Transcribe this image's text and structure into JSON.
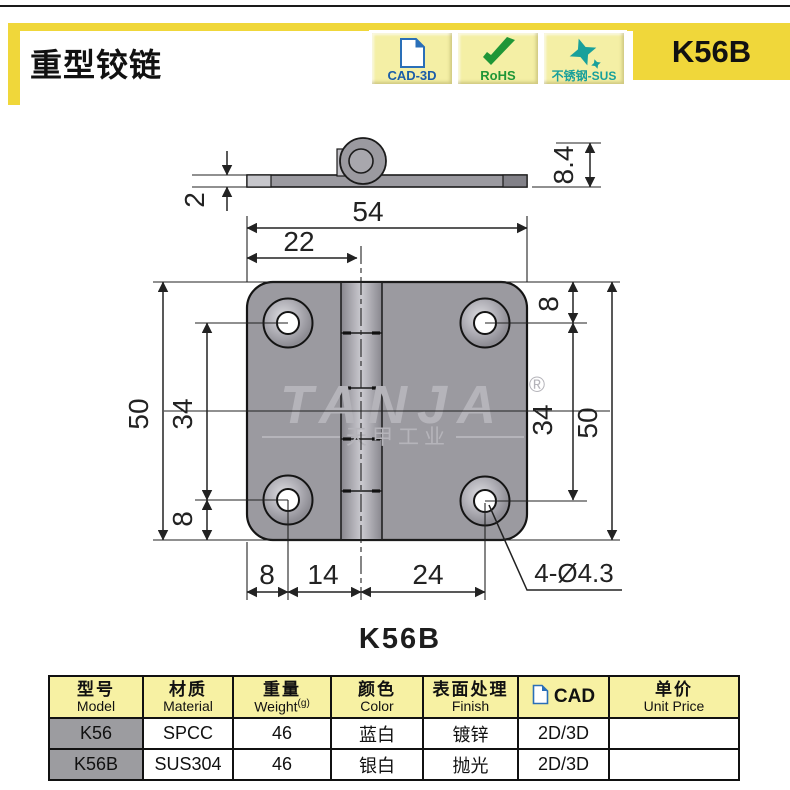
{
  "header": {
    "title": "重型铰链",
    "product_code": "K56B",
    "badges": [
      {
        "label": "CAD-3D",
        "icon": "document-icon",
        "color": "#1A5DA8"
      },
      {
        "label": "RoHS",
        "icon": "check-icon",
        "color": "#1F9637"
      },
      {
        "label": "不锈钢-SUS",
        "icon": "sparkle-icon",
        "color": "#18A09B"
      }
    ]
  },
  "drawing": {
    "caption": "K56B",
    "watermark": {
      "brand": "TANJA",
      "registered": "®",
      "sub": "天甲工业"
    },
    "dims": {
      "profile_thickness": "2",
      "profile_height": "8.4",
      "width": "54",
      "pin_offset": "22",
      "left_height": "50",
      "left_hole_span": "34",
      "left_bottom_edge": "8",
      "right_top_edge": "8",
      "right_hole_span": "34",
      "right_height": "50",
      "bottom_edge": "8",
      "bottom_hole_to_pin": "14",
      "bottom_pin_to_hole": "24",
      "hole_callout": "4-Ø4.3"
    }
  },
  "table": {
    "cols": [
      {
        "zh": "型号",
        "en": "Model"
      },
      {
        "zh": "材质",
        "en": "Material"
      },
      {
        "zh": "重量",
        "en": "Weight",
        "sup": "(g)"
      },
      {
        "zh": "颜色",
        "en": "Color"
      },
      {
        "zh": "表面处理",
        "en": "Finish"
      },
      {
        "label": "CAD"
      },
      {
        "zh": "单价",
        "en": "Unit Price"
      }
    ],
    "rows": [
      {
        "model": "K56",
        "material": "SPCC",
        "weight": "46",
        "color": "蓝白",
        "finish": "镀锌",
        "cad": "2D/3D",
        "price": ""
      },
      {
        "model": "K56B",
        "material": "SUS304",
        "weight": "46",
        "color": "银白",
        "finish": "抛光",
        "cad": "2D/3D",
        "price": ""
      }
    ]
  },
  "colors": {
    "accent_yellow": "#F0D73A",
    "badge_bg": "#F4EFA5",
    "cad_blue": "#1A5DA8",
    "rohs_green": "#1F9637",
    "sus_teal": "#18A09B",
    "table_header_bg": "#F7F1A3",
    "model_cell_bg": "#9C9CA0",
    "plate_gray": "#9B9AA0"
  }
}
